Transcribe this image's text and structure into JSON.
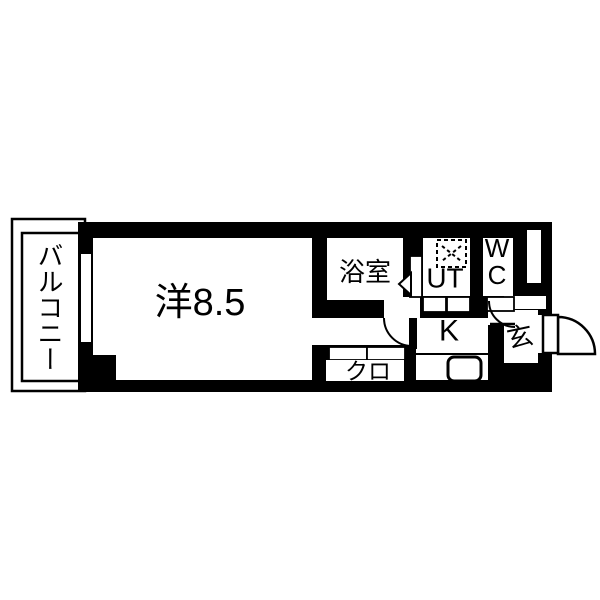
{
  "page": {
    "background_color": "#ffffff"
  },
  "floorplan": {
    "type": "apartment-floor-plan",
    "wall_color": "#000000",
    "floor_color": "#ffffff",
    "labels": {
      "balcony": "バルコニー",
      "main_room": "洋8.5",
      "bathroom": "浴室",
      "utility": "UT",
      "toilet_line1": "W",
      "toilet_line2": "C",
      "kitchen": "K",
      "closet": "クロ",
      "entrance": "玄"
    },
    "fixtures": {
      "washing_machine_icon": "dashed-square-with-x",
      "kitchen_sink_icon": "rounded-rect-basin",
      "entrance_door_icon": "quarter-circle-door-swing",
      "room_door_icon": "door-leaf-with-arc",
      "wc_door_icon": "door-leaf-with-arc",
      "bathroom_door_icon": "left-pointing-triangle",
      "window_icon": "wall-window-slot",
      "sliding_door_icon": "double-panel-rects"
    }
  }
}
